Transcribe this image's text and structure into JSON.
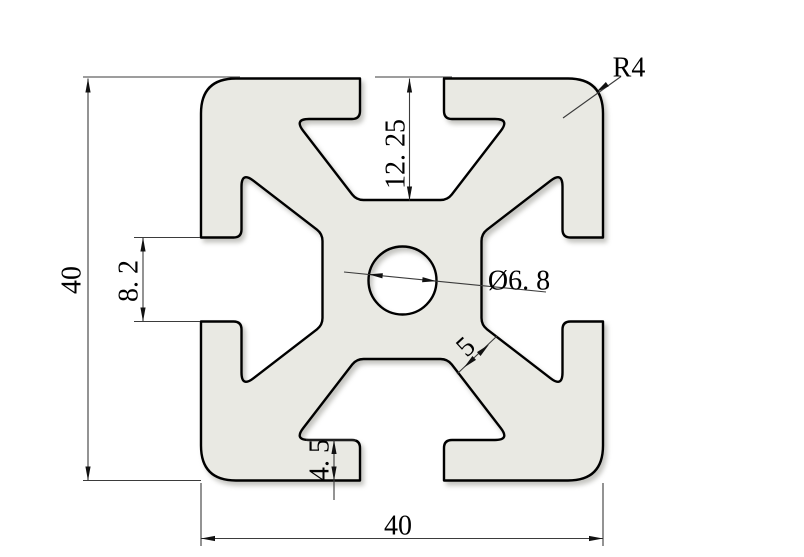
{
  "drawing": {
    "description": "Cross-section technical drawing of a 4040 T-slot aluminum extrusion profile",
    "colors": {
      "background": "#ffffff",
      "profile_fill": "#e9e9e3",
      "outline": "#000000",
      "dimension_lines": "#3b3b3b",
      "text": "#000000"
    },
    "dimensions": {
      "overall_height": {
        "label": "40",
        "value": 40
      },
      "overall_width": {
        "label": "40",
        "value": 40
      },
      "slot_depth": {
        "label": "12. 25",
        "value": 12.25
      },
      "slot_opening": {
        "label": "8. 2",
        "value": 8.2
      },
      "lip_thickness": {
        "label": "4. 5",
        "value": 4.5
      },
      "arm_width": {
        "label": "5",
        "value": 5
      },
      "center_hole_diameter": {
        "label": "Ø6. 8",
        "value": 6.8
      },
      "corner_radius": {
        "label": "R4",
        "value": 4
      }
    }
  }
}
